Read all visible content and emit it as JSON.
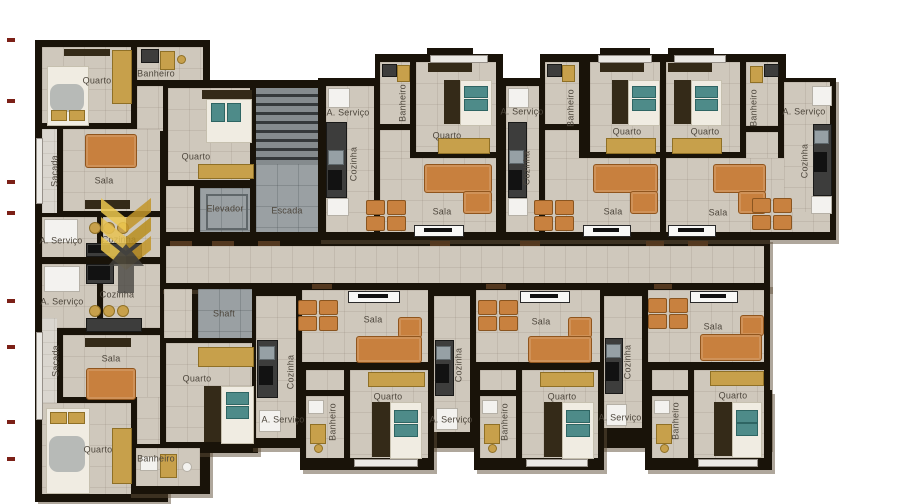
{
  "image_type": "apartment building floor plan (3D rendered top view)",
  "language": "pt-BR",
  "colors": {
    "background": "#ffffff",
    "wall": "#191309",
    "floor_tile": "#cfc8bc",
    "balcony_floor": "#dad6cf",
    "service_gray": "#9aa0a3",
    "furniture_wood": "#c8803e",
    "cabinet_gold": "#c7a04b",
    "pillow_teal": "#4e8b89",
    "logo_gold": "#e8c353",
    "logo_dark": "#45433f",
    "edge_marks_red": "#7c2017"
  },
  "logo": {
    "name": "gold-chevron-builder-logo",
    "text": ""
  },
  "room_labels": [
    {
      "label": "Quarto",
      "x": 97,
      "y": 81,
      "vertical": false
    },
    {
      "label": "Banheiro",
      "x": 156,
      "y": 74,
      "vertical": false
    },
    {
      "label": "Quarto",
      "x": 196,
      "y": 157,
      "vertical": false
    },
    {
      "label": "Sala",
      "x": 104,
      "y": 181,
      "vertical": false
    },
    {
      "label": "Sacada",
      "x": 55,
      "y": 171,
      "vertical": true
    },
    {
      "label": "Elevador",
      "x": 225,
      "y": 209,
      "vertical": false
    },
    {
      "label": "Escada",
      "x": 287,
      "y": 211,
      "vertical": false
    },
    {
      "label": "A. Serviço",
      "x": 61,
      "y": 241,
      "vertical": false
    },
    {
      "label": "Cozinha",
      "x": 119,
      "y": 240,
      "vertical": false
    },
    {
      "label": "A. Serviço",
      "x": 348,
      "y": 113,
      "vertical": false
    },
    {
      "label": "Banheiro",
      "x": 403,
      "y": 103,
      "vertical": true
    },
    {
      "label": "Quarto",
      "x": 447,
      "y": 136,
      "vertical": false
    },
    {
      "label": "Cozinha",
      "x": 354,
      "y": 164,
      "vertical": true
    },
    {
      "label": "Sala",
      "x": 442,
      "y": 212,
      "vertical": false
    },
    {
      "label": "A. Serviço",
      "x": 522,
      "y": 112,
      "vertical": false
    },
    {
      "label": "Banheiro",
      "x": 571,
      "y": 108,
      "vertical": true
    },
    {
      "label": "Quarto",
      "x": 627,
      "y": 132,
      "vertical": false
    },
    {
      "label": "Cozinha",
      "x": 527,
      "y": 168,
      "vertical": true
    },
    {
      "label": "Sala",
      "x": 613,
      "y": 212,
      "vertical": false
    },
    {
      "label": "Quarto",
      "x": 705,
      "y": 132,
      "vertical": false
    },
    {
      "label": "Banheiro",
      "x": 754,
      "y": 108,
      "vertical": true
    },
    {
      "label": "A. Serviço",
      "x": 804,
      "y": 112,
      "vertical": false
    },
    {
      "label": "Cozinha",
      "x": 805,
      "y": 161,
      "vertical": true
    },
    {
      "label": "Sala",
      "x": 718,
      "y": 213,
      "vertical": false
    },
    {
      "label": "A. Serviço",
      "x": 62,
      "y": 302,
      "vertical": false
    },
    {
      "label": "Cozinha",
      "x": 117,
      "y": 295,
      "vertical": false
    },
    {
      "label": "Sacada",
      "x": 56,
      "y": 361,
      "vertical": true
    },
    {
      "label": "Sala",
      "x": 111,
      "y": 359,
      "vertical": false
    },
    {
      "label": "Shaft",
      "x": 224,
      "y": 314,
      "vertical": false
    },
    {
      "label": "Quarto",
      "x": 197,
      "y": 379,
      "vertical": false
    },
    {
      "label": "Cozinha",
      "x": 291,
      "y": 372,
      "vertical": true
    },
    {
      "label": "A. Serviço",
      "x": 283,
      "y": 420,
      "vertical": false
    },
    {
      "label": "Quarto",
      "x": 98,
      "y": 450,
      "vertical": false
    },
    {
      "label": "Banheiro",
      "x": 156,
      "y": 459,
      "vertical": false
    },
    {
      "label": "Sala",
      "x": 373,
      "y": 320,
      "vertical": false
    },
    {
      "label": "Quarto",
      "x": 388,
      "y": 397,
      "vertical": false
    },
    {
      "label": "Banheiro",
      "x": 333,
      "y": 422,
      "vertical": true
    },
    {
      "label": "Cozinha",
      "x": 459,
      "y": 365,
      "vertical": true
    },
    {
      "label": "A. Serviço",
      "x": 451,
      "y": 420,
      "vertical": false
    },
    {
      "label": "Sala",
      "x": 541,
      "y": 322,
      "vertical": false
    },
    {
      "label": "Quarto",
      "x": 562,
      "y": 397,
      "vertical": false
    },
    {
      "label": "Banheiro",
      "x": 505,
      "y": 422,
      "vertical": true
    },
    {
      "label": "Cozinha",
      "x": 628,
      "y": 362,
      "vertical": true
    },
    {
      "label": "A. Serviço",
      "x": 620,
      "y": 418,
      "vertical": false
    },
    {
      "label": "Sala",
      "x": 713,
      "y": 327,
      "vertical": false
    },
    {
      "label": "Quarto",
      "x": 733,
      "y": 396,
      "vertical": false
    },
    {
      "label": "Banheiro",
      "x": 676,
      "y": 421,
      "vertical": true
    }
  ]
}
